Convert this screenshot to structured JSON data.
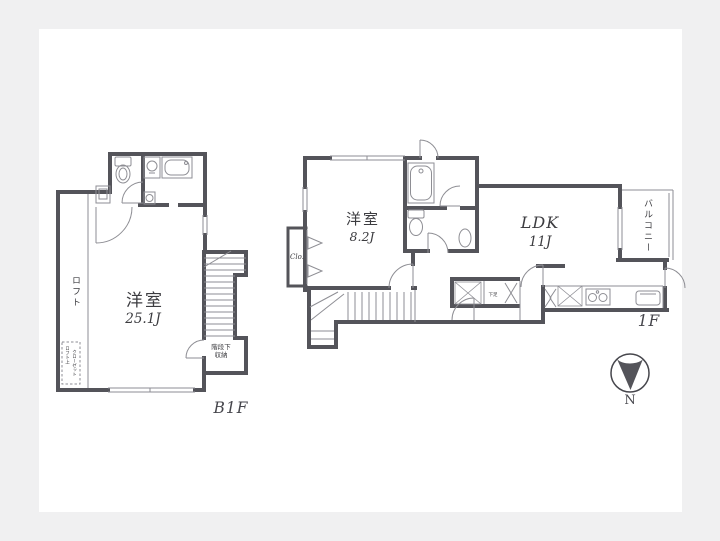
{
  "colors": {
    "frame": "#f0f0f1",
    "canvas": "#ffffff",
    "wall": "#54545a",
    "thin": "#8e8e94",
    "text": "#3c3c40",
    "label": "#46464c"
  },
  "b1f": {
    "floor_label": "B1F",
    "room_name": "洋室",
    "room_size": "25.1J",
    "loft_label": "ロフト",
    "storage_line1": "階段下",
    "storage_line2": "収納",
    "closet_col1": "ロフト上",
    "closet_col2": "クローゼット"
  },
  "f1": {
    "floor_label": "1F",
    "bedroom_name": "洋室",
    "bedroom_size": "8.2J",
    "ldk_name": "LDK",
    "ldk_size": "11J",
    "balcony_label": "バルコニー",
    "closet_label": "Clo.",
    "shoe_label": "下足"
  },
  "compass": {
    "north": "N"
  }
}
